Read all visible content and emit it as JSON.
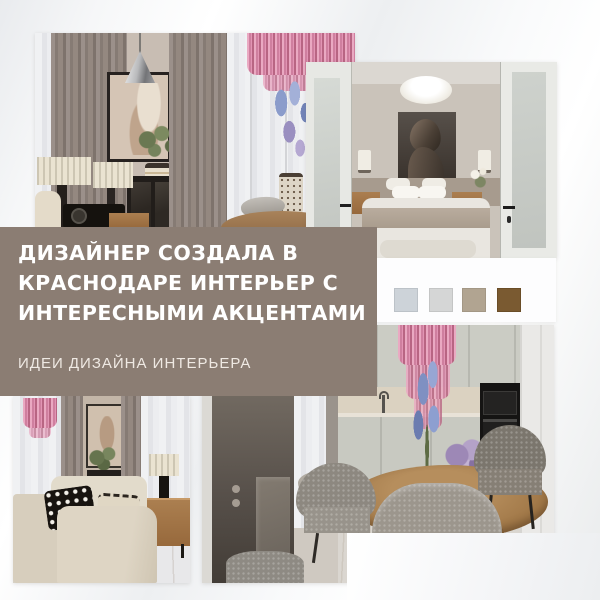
{
  "text_block": {
    "title_lines": [
      "ДИЗАЙНЕР СОЗДАЛА В",
      "КРАСНОДАРЕ ИНТЕРЬЕР С",
      "ИНТЕРЕСНЫМИ АКЦЕНТАМИ"
    ],
    "subtitle": "ИДЕИ ДИЗАЙНА ИНТЕРЬЕРА",
    "background_color": "#8b7d73",
    "title_color": "#ffffff",
    "subtitle_color": "#efe9e3"
  },
  "palette_card": {
    "background_color": "#fdfdfe",
    "swatches": [
      {
        "name": "pale-blue-gray",
        "color": "#cdd3d9"
      },
      {
        "name": "light-gray",
        "color": "#d5d6d6"
      },
      {
        "name": "greige",
        "color": "#b1a491"
      },
      {
        "name": "brown",
        "color": "#7a5a31"
      }
    ]
  },
  "photos": [
    {
      "id": "living-room-art-wall",
      "description": "Living room with taupe curtains, framed abstract art, chrome cone pendant, black cabinet, pleated table lamps, record player, pink cascade chandelier and blue flowers"
    },
    {
      "id": "bedroom-through-doors",
      "description": "Bedroom seen through open white double doors with dark profile-head artwork, saucer pendant, wall sconces and bed with taupe throw"
    },
    {
      "id": "living-room-sofa",
      "description": "Living room with beige modular sofa, checkered pillow, wood sideboard, black table lamp and pink chandelier fragment"
    },
    {
      "id": "kitchen-dining",
      "description": "Kitchen-dining room with gray cabinets, black appliances, dark door, round wood table, boucle chairs, pink chandelier, delphiniums and hydrangeas"
    }
  ]
}
